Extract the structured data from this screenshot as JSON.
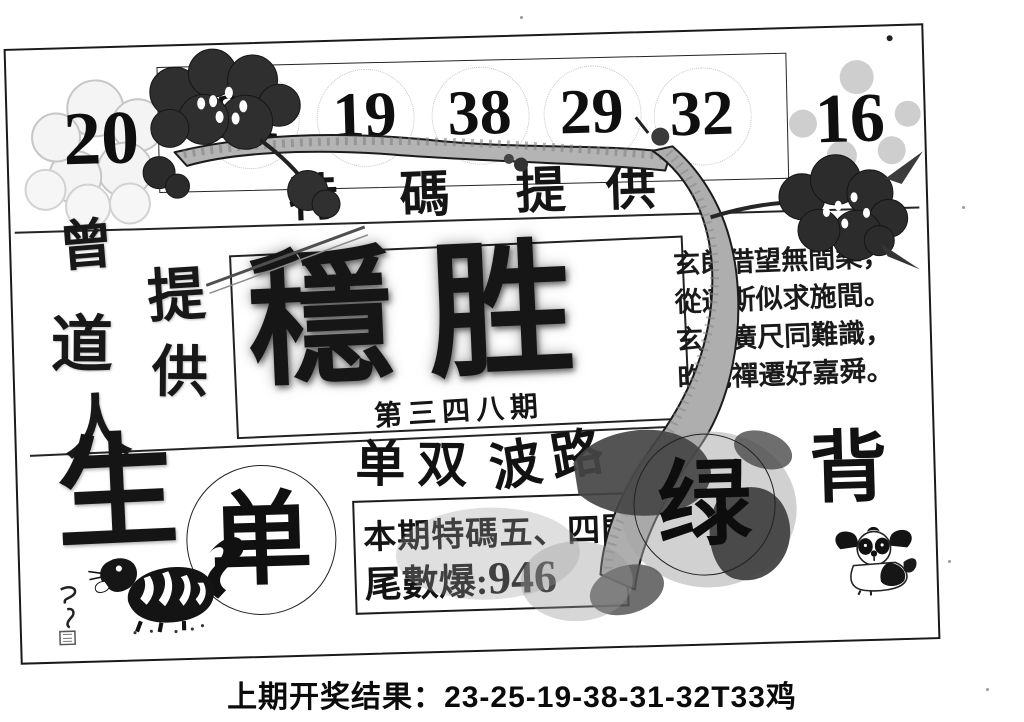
{
  "page": {
    "footer_label": "上期开奖结果：",
    "footer_value": "23-25-19-38-31-32T33鸡"
  },
  "sheet": {
    "numbers": [
      "20",
      "21",
      "19",
      "38",
      "29",
      "32",
      "16"
    ],
    "top_label": "特碼提供",
    "top_label_chars": [
      "特",
      "碼",
      "提",
      "供"
    ],
    "left": {
      "brand_chars": [
        "曾",
        "道",
        "人"
      ],
      "provide_chars": [
        "提",
        "供"
      ],
      "life_char": "生"
    },
    "title": {
      "main": "穩胜",
      "issue": "第三四八期"
    },
    "poem_lines": [
      "玄郎借望無間樂，",
      "從遭斯似求施間。",
      "玄州廣尺同難識，",
      "昨說禪遷好嘉舜。"
    ],
    "picks": {
      "odd": "单",
      "odd_even": "单双",
      "bolu": "波路",
      "special": "本期特碼五、四門,",
      "tail_label": "尾數爆:",
      "tail_value": "946",
      "green": "绿",
      "back": "背"
    },
    "art": {
      "branch": "plum-branch",
      "blossom_dark": "plum-blossom-dark",
      "blossom_light": "plum-blossom-outline",
      "tiger": "tiger-ink-drawing",
      "dog": "shihtzu-ink-drawing",
      "signature": "artist-seal"
    },
    "colors": {
      "ink": "#151515",
      "paper": "#ffffff",
      "branch_gray": "#aeaeae",
      "leaf_dark": "#3d3d3d",
      "petal_gray": "#bdbdbd"
    }
  }
}
